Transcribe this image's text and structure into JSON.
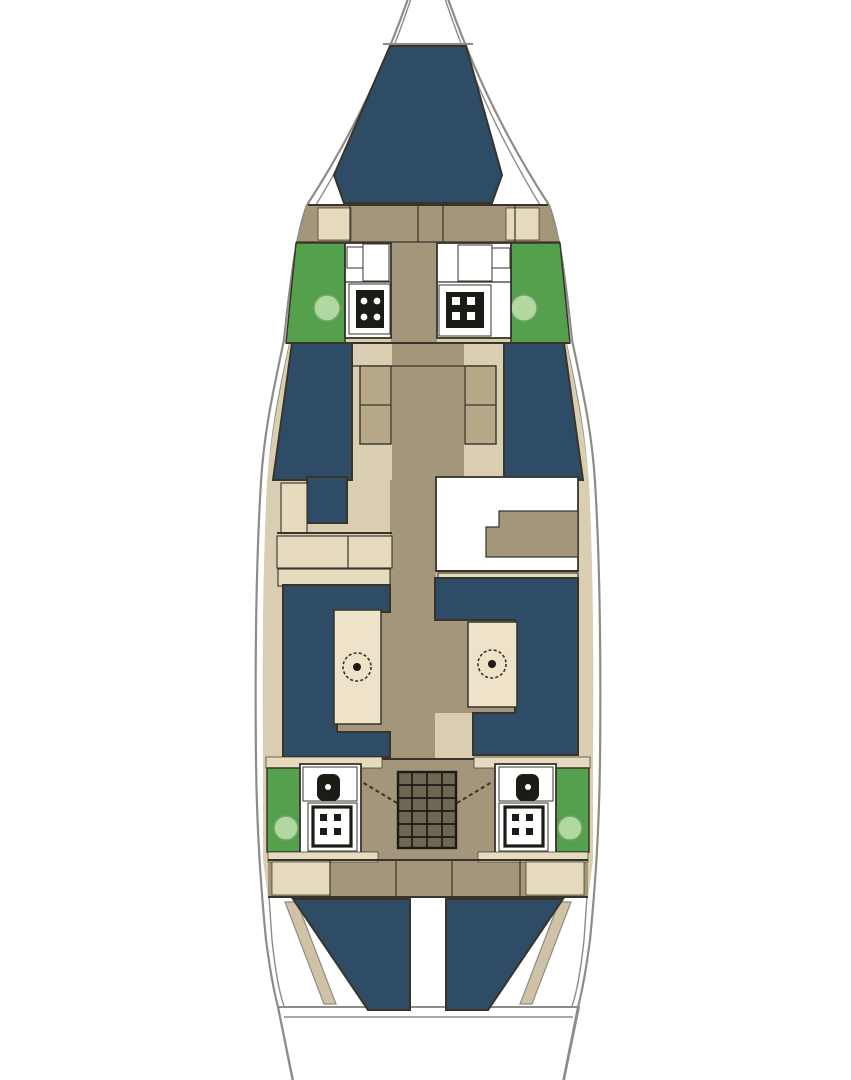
{
  "diagram": {
    "title": "Sailing yacht interior layout plan (top view, bow up)",
    "type": "boat-floor-plan",
    "orientation": "bow-up",
    "visible_text": [],
    "areas": {
      "bow": [
        "v-berth"
      ],
      "forward": [
        "forward-head-port",
        "forward-head-starboard",
        "forward-cabin-berth-port",
        "forward-cabin-berth-starboard",
        "wardrobe-lockers",
        "central-corridor"
      ],
      "midship": [
        "port-sideboard-cabinets",
        "galley-counter"
      ],
      "saloon": [
        "settee-port",
        "saloon-table-port",
        "settee-starboard",
        "saloon-table-starboard",
        "walkway"
      ],
      "aft": [
        "aft-head-port",
        "aft-head-starboard",
        "companionway-steps",
        "aft-berth-port",
        "aft-berth-starboard",
        "transom"
      ]
    },
    "fixture_counts": {
      "sinks": 4,
      "shower-grates": 4,
      "toilets": 2,
      "tables": 2,
      "berths": 5,
      "companionway-steps": 1
    }
  },
  "colors": {
    "background": "#ffffff",
    "hullLine": "#8d8d87",
    "outline": "#38342a",
    "black": "#1d1b15",
    "berthNavy": "#2e4c66",
    "floorTan": "#a3967b",
    "furnitureCream": "#d9cdb2",
    "furnitureCream2": "#e6dabf",
    "lockerTan": "#b7a88a",
    "tableCream": "#eee2c9",
    "wetAreaGreen": "#55a04c",
    "sinkLightGreen": "#b2d8a2",
    "sinkStroke": "#74a566",
    "stepsBrown": "#6f6754",
    "diagonalTan": "#cfc2a6",
    "white": "#ffffff"
  }
}
